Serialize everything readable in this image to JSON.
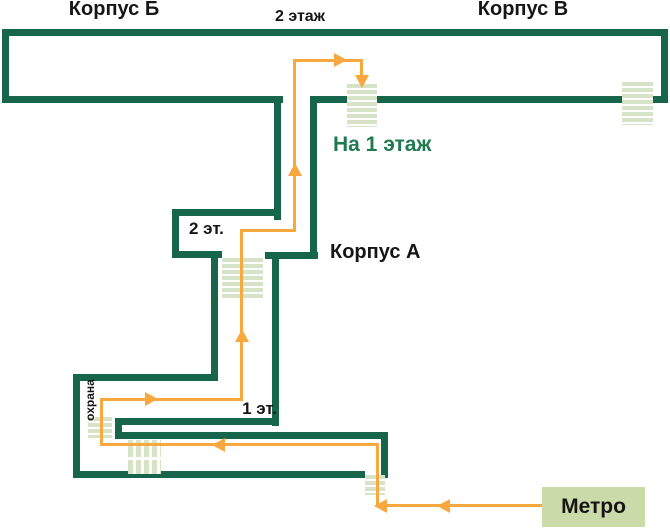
{
  "diagram": {
    "buildings": {
      "b": "Корпус Б",
      "v": "Корпус В",
      "a": "Корпус А"
    },
    "labels": {
      "floor2": "2 этаж",
      "floor2_short": "2 эт.",
      "floor1_short": "1 эт.",
      "to_floor1": "На 1 этаж",
      "security": "охрана",
      "metro": "Метро"
    },
    "icons": {
      "stairs": "stairs-icon (striped rectangle)",
      "route_arrow": "arrowhead-icon"
    },
    "colors": {
      "wall": "#17654B",
      "route": "#F8A83E",
      "stairs": "#D6E3C6",
      "metro_box": "#CBDAA9",
      "accent_text": "#1F7A50",
      "text": "#161616"
    }
  }
}
